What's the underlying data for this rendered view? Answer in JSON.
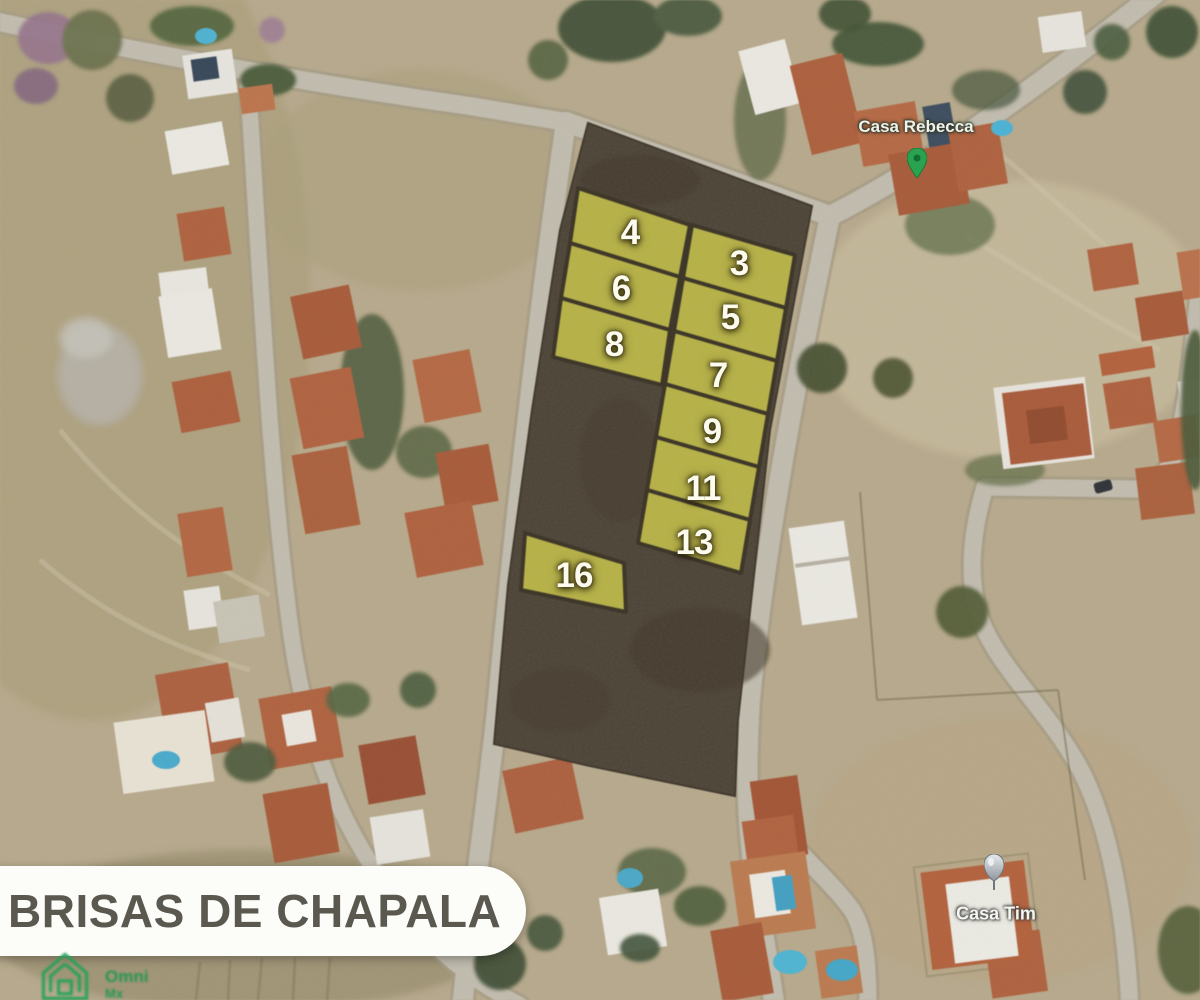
{
  "map": {
    "view": "satellite",
    "development_name": "Brisas de Chapala"
  },
  "banner": {
    "title": "BRISAS DE CHAPALA"
  },
  "watermark": {
    "icon": "green-house-outline",
    "line1": "Omni",
    "line2": "Mx"
  },
  "pins": {
    "rebecca": {
      "label": "Casa Rebecca",
      "pin_color": "#2ba24f"
    },
    "tim": {
      "label": "Casa Tim",
      "pin_color": "#b9bdc4"
    }
  },
  "lots": [
    {
      "id": "lot-4",
      "number": "4"
    },
    {
      "id": "lot-3",
      "number": "3"
    },
    {
      "id": "lot-6",
      "number": "6"
    },
    {
      "id": "lot-5",
      "number": "5"
    },
    {
      "id": "lot-8",
      "number": "8"
    },
    {
      "id": "lot-7",
      "number": "7"
    },
    {
      "id": "lot-9",
      "number": "9"
    },
    {
      "id": "lot-11",
      "number": "11"
    },
    {
      "id": "lot-13",
      "number": "13"
    },
    {
      "id": "lot-16",
      "number": "16"
    }
  ],
  "palette": {
    "highlighted_lot": "#bcb73f",
    "parcel_dark": "#473d2e",
    "road": "#c3bdae",
    "scrub": "#b9aa8a"
  }
}
